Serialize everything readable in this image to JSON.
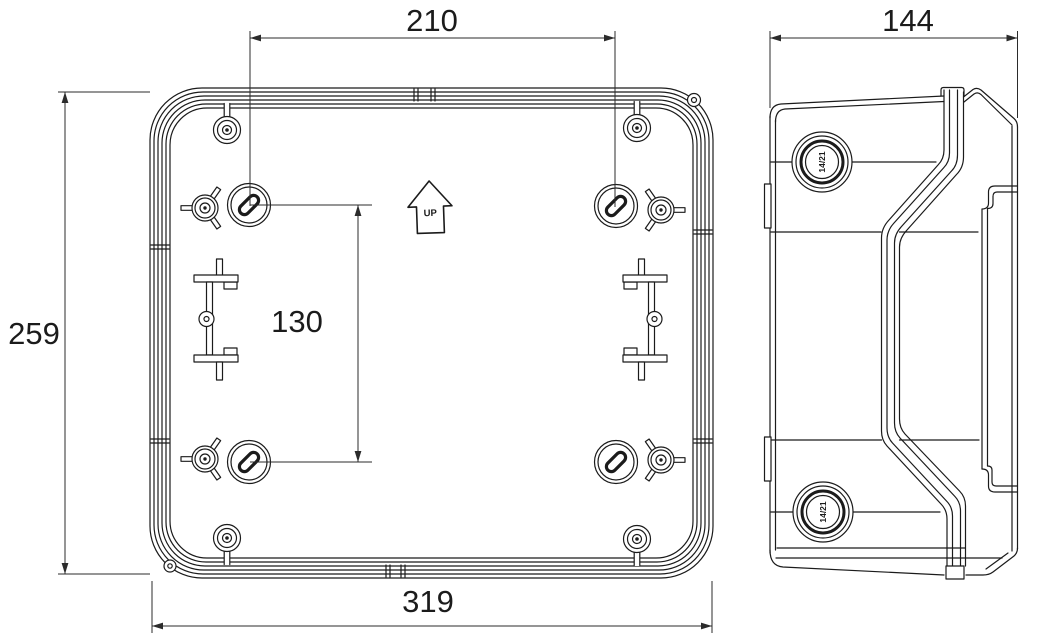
{
  "drawing": {
    "units": "mm",
    "dimensions": {
      "width": "319",
      "height": "259",
      "depth": "144",
      "hole_spacing_h": "210",
      "hole_spacing_v": "130"
    },
    "labels": {
      "up": "UP",
      "knockout_top": "14/21",
      "knockout_bottom": "14/21"
    },
    "colors": {
      "line": "#1b1b1b",
      "dimension_line": "#2b2b2b",
      "background": "#ffffff"
    }
  }
}
